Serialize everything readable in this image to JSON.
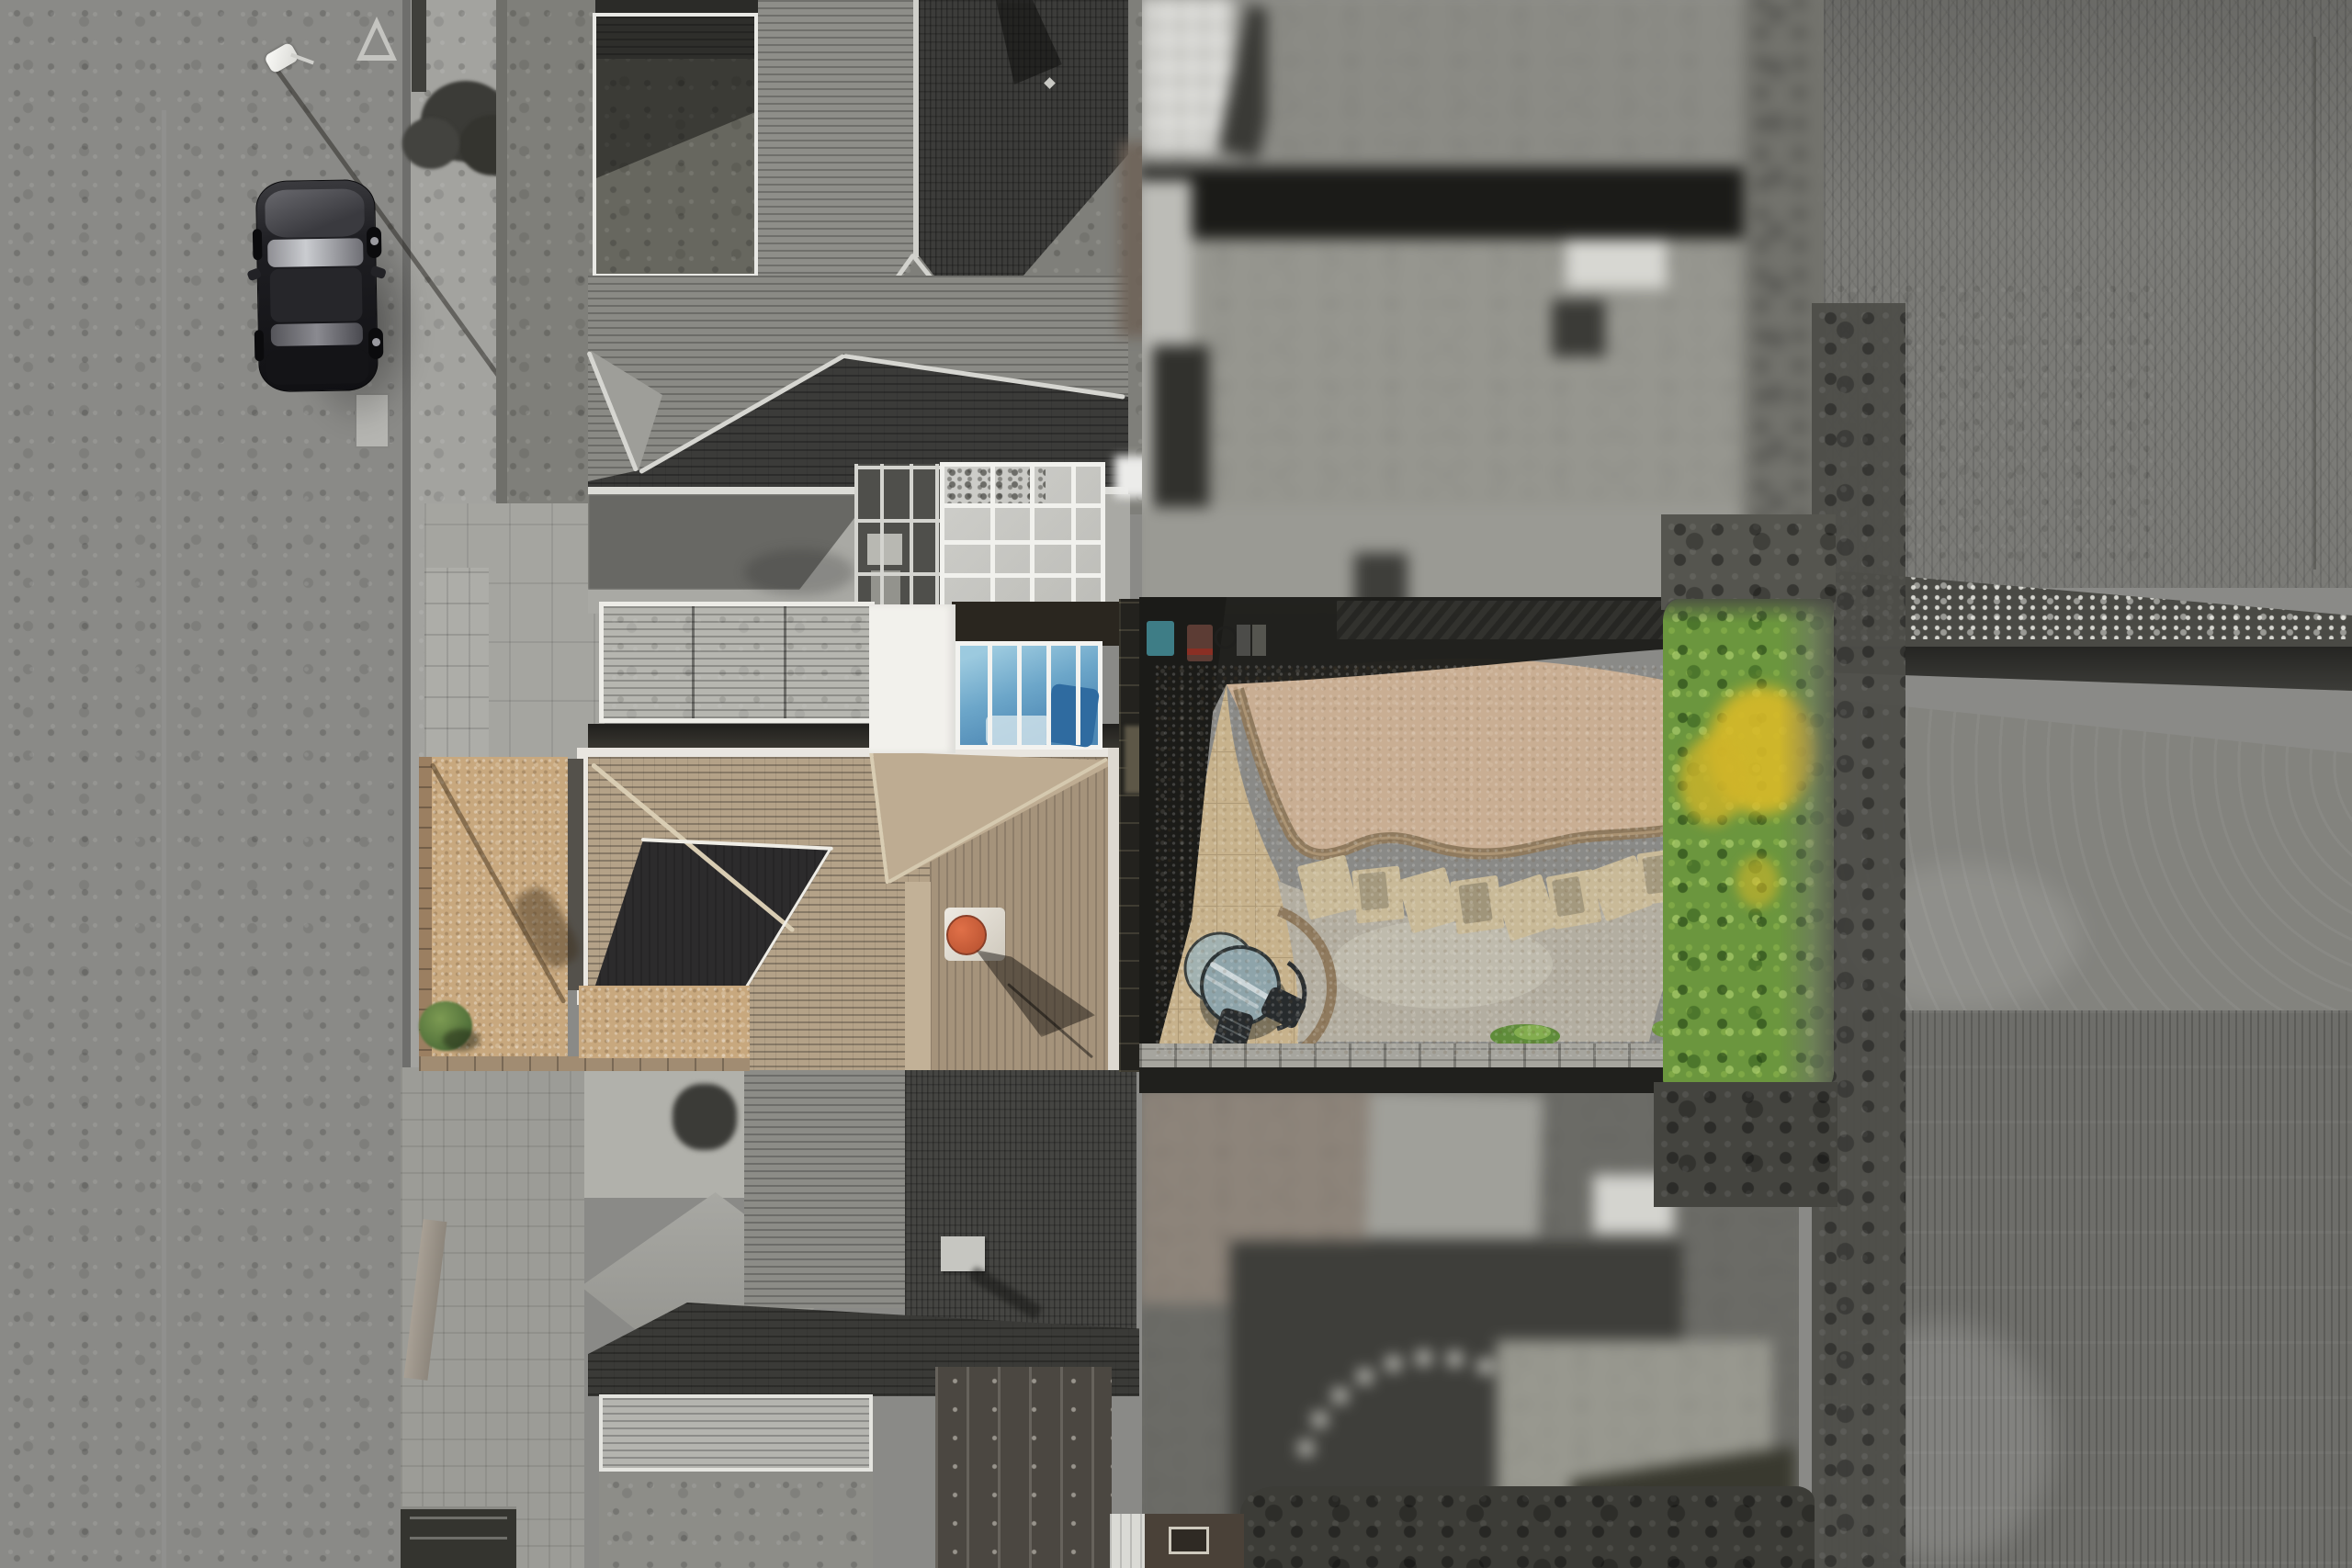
{
  "scene": {
    "type": "aerial-drone-photograph",
    "style": "top-down nadir view of a residential plot; the subject property is shown in colour while the street, neighbouring houses and farmland are desaturated to grayscale; the two adjoining rear gardens are pixel-blurred for privacy",
    "orientation": "street on the left, houses in the middle, rear garden, hedge and farm fields on the right"
  },
  "palette": {
    "road": "#8a8a87",
    "sidewalk": "#a3a39f",
    "lawn-gray": "#7f7f7a",
    "roof-dark": "#3c3c3a",
    "roof-mid": "#8e8e89",
    "roof-light": "#a4a4a0",
    "courtyard": "#a9a9a4",
    "conservatory-glass": "#c9c9c5",
    "white-roof": "#f2f1ec",
    "white-frame": "#f1f1ed",
    "sky-glass-light": "#9ccadf",
    "sky-glass-deep": "#4e88b4",
    "roof-tan": "#b4a288",
    "roof-tan-dark": "#a5937b",
    "ridge-light": "#d9cdb3",
    "porch-dark": "#2c2b2c",
    "chimney-cap": "#c85a35",
    "gravel-front": "#c8a87e",
    "gravel-pink": "#c9ae93",
    "gravel-gray": "#b3aea1",
    "patio-stone": "#c7b28c",
    "brick-edge": "#8f7a5e",
    "stepping-stone": "#c9ba98",
    "hedge-green": "#6b963e",
    "hedge-green-dark": "#4c7230",
    "hedge-yellow": "#d9ba28",
    "field-top": "#7b7b77",
    "field-mid": "#83837e",
    "field-bottom": "#6e6e6a",
    "hedgerow-dark": "#4a4a45",
    "shadow-dark": "#1b1b18",
    "car-body": "#1a1a1d",
    "bin-teal": "#3e7d86",
    "bin-red": "#5c3c34",
    "table-glass": "#8ea4aa",
    "trellis": "#a6a59e"
  },
  "street": {
    "surface": "grayscale asphalt road running vertically",
    "markings": [
      "give-way triangle marking",
      "manhole cover",
      "kerb and paved footway"
    ],
    "lamp_post": "white lamp head with long diagonal shadow cast to the lower right",
    "parked_car": {
      "type": "dark hatchback parked along the kerb",
      "colour": "#1a1a1d"
    },
    "roadside_tree": "dark shrub/tree with long shadow",
    "timber_board": "loose plank on the footway further down",
    "gate": "dark side gate at the bottom edge"
  },
  "subject_property": {
    "front_garden": {
      "surface": "golden gravel",
      "colour": "#c8a87e",
      "details": [
        "telegraph-pole shadow across the gravel",
        "small green shrub",
        "brown brick boundary wall",
        "block edging at the drive"
      ]
    },
    "house": {
      "roof": {
        "material": "tan/buff concrete tile hipped roof",
        "colour": "#b4a288",
        "features": [
          "pale ridge and valley lines",
          "dark shadowed porch slope inset",
          "white gutter edges"
        ]
      },
      "chimney": {
        "body": "white/light grey flue box",
        "cap_colour": "#c85a35",
        "shadow": "long diagonal shadow down-right"
      },
      "rear_extension": {
        "flat_roof_colour": "#f2f1ec",
        "skylight": {
          "type": "glazed blue glass roof",
          "colours": [
            "#9ccadf",
            "#4e88b4"
          ],
          "mullions": "white"
        }
      },
      "garage_roof": "light grey corrugated roof with white frame",
      "conservatory_roof": "white-framed frosted glass grid (grayscale)",
      "greenhouse_shelving": "metal frame unit with boxes beside the conservatory"
    },
    "back_garden": {
      "shadow_band": "deep shadow cast across the top of the garden",
      "bins": [
        "teal wheelie bin #3e7d86",
        "brown bin with red stripe #5c3c34",
        "dark bins and a hose ring"
      ],
      "patio": {
        "material": "buff flagstone paving",
        "colour": "#c7b28c"
      },
      "upper_gravel_bed": {
        "colour": "#c9ae93",
        "edging": "curved double-brick border #8f7a5e in an S shape"
      },
      "stepping_stones": {
        "count": 8,
        "colour": "#c9ba98",
        "note": "large slabs set in an arc, some moss stained"
      },
      "lower_gravel": {
        "colour": "#b3aea1"
      },
      "weeds": "small green clumps near the rear fence",
      "furniture": {
        "bistro_table": "round glass-topped table #8ea4aa",
        "chairs": "dark metal chairs"
      },
      "rear_boundary": {
        "trellis_fence": "#a6a59e",
        "hedge": {
          "colour": "#6b963e",
          "yellow_flower_patches": "#d9ba28"
        }
      }
    }
  },
  "neighbours": {
    "upper_house": "dark grey tiled hipped roofs, flat mossy garage roof, paved courtyard and glass conservatory (grayscale)",
    "lower_house": "mirrored semi-detached half: grey hipped roofs, brick driveway, bay roof, rusty flat roof and corrugated garage (grayscale)",
    "garden_above": "privacy-blurred grayscale garden with lawn, dark fence shadow band and pale paving",
    "garden_below": "privacy-blurred grayscale garden with pale shed roof, dark lawn and curved stepping-stone path"
  },
  "farmland": {
    "field_top": "grayscale ploughed field with faint crop rows and tractor marks",
    "hedgerow": "dark hedgerow with white blossom crossing the fields",
    "field_middle": "lighter grazed field with curved tractor lines",
    "field_bottom": "grayscale field with strong vertical crop rows",
    "boundary_scrub": "dark grayscale scrub strip directly behind the garden hedge"
  }
}
